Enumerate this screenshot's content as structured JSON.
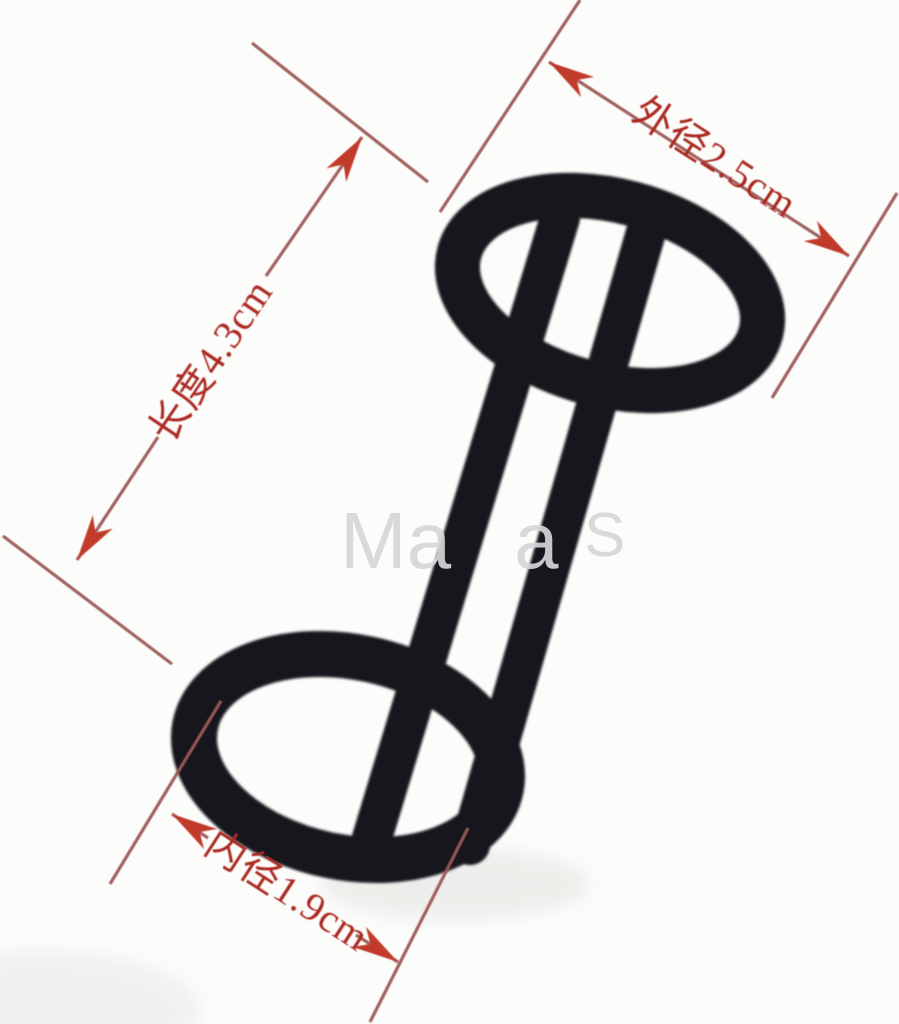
{
  "annotations": {
    "labels": [
      {
        "id": "outer-diameter",
        "text": "外径2.5cm",
        "measure": "外径",
        "value": "2.5",
        "unit": "cm"
      },
      {
        "id": "length",
        "text": "长度4.3cm",
        "measure": "长度",
        "value": "4.3",
        "unit": "cm"
      },
      {
        "id": "inner-diameter",
        "text": "内径1.9cm",
        "measure": "内径",
        "value": "1.9",
        "unit": "cm"
      }
    ],
    "line_color": "#9c5a55",
    "arrow_color": "#c23a2c",
    "label_color": "#ab2b22"
  },
  "watermark": {
    "fragments": [
      "Ma",
      "a",
      "S"
    ],
    "color": "#d6d6da"
  },
  "object": {
    "description": "black double ring connected by two parallel bars",
    "color": "#17171d",
    "shadow_color": "#dcdcd8"
  },
  "background": "#fcfcfb"
}
